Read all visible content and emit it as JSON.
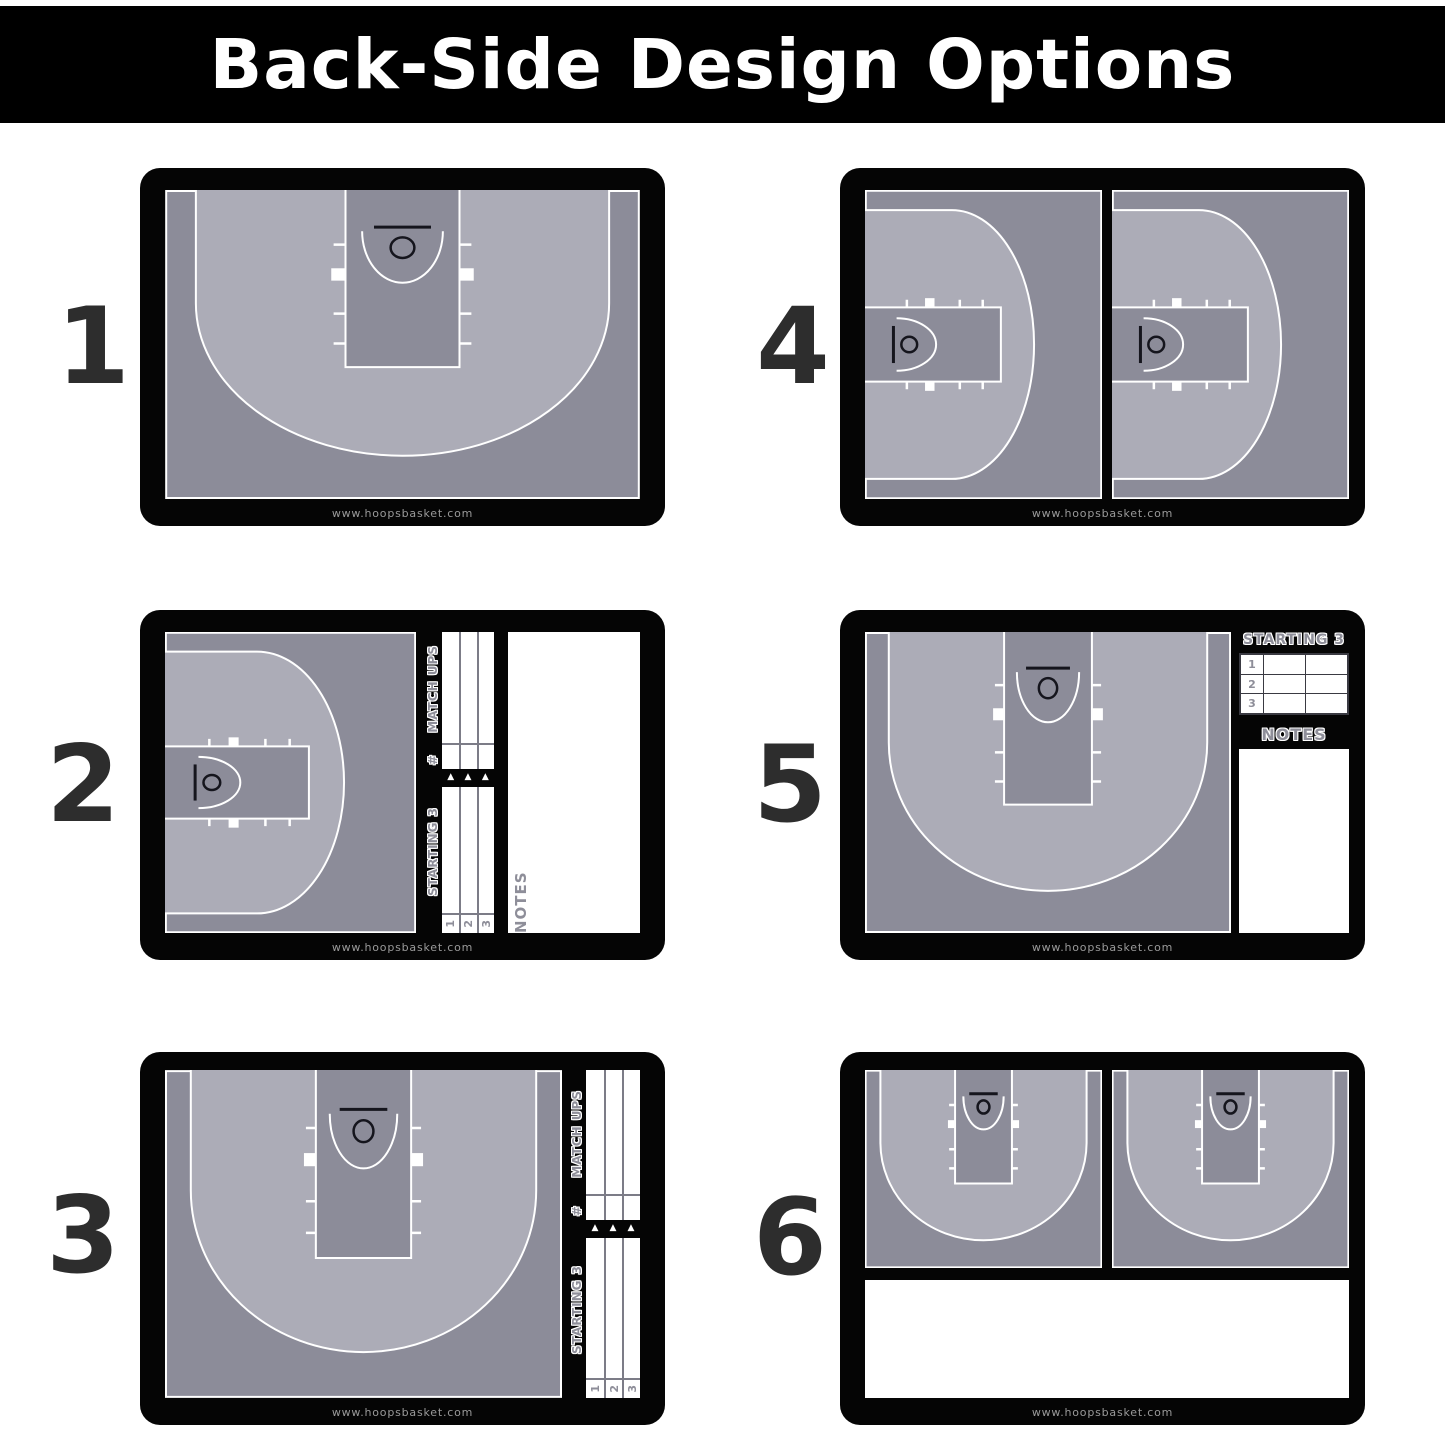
{
  "title": "Back-Side Design Options",
  "watermark": "www.hoopsbasket.com",
  "boards": [
    {
      "number": "1"
    },
    {
      "number": "2"
    },
    {
      "number": "3"
    },
    {
      "number": "4"
    },
    {
      "number": "5"
    },
    {
      "number": "6"
    }
  ],
  "panel_labels": {
    "match_ups": "MATCH UPS",
    "hash": "#",
    "starting_3": "STARTING 3",
    "notes": "NOTES",
    "row_numbers": [
      "1",
      "2",
      "3"
    ],
    "triangle": "▲"
  },
  "colors": {
    "banner_bg": "#000000",
    "banner_text": "#FFFFFF",
    "frame": "#050505",
    "court_dark": "#8C8C99",
    "court_light": "#ACACB7",
    "court_line": "#FFFFFF",
    "hoop_marks": "#15151D",
    "option_number": "#2D2D2D",
    "panel_label": "#8E8E99",
    "watermark_text": "#9A9A9A"
  }
}
